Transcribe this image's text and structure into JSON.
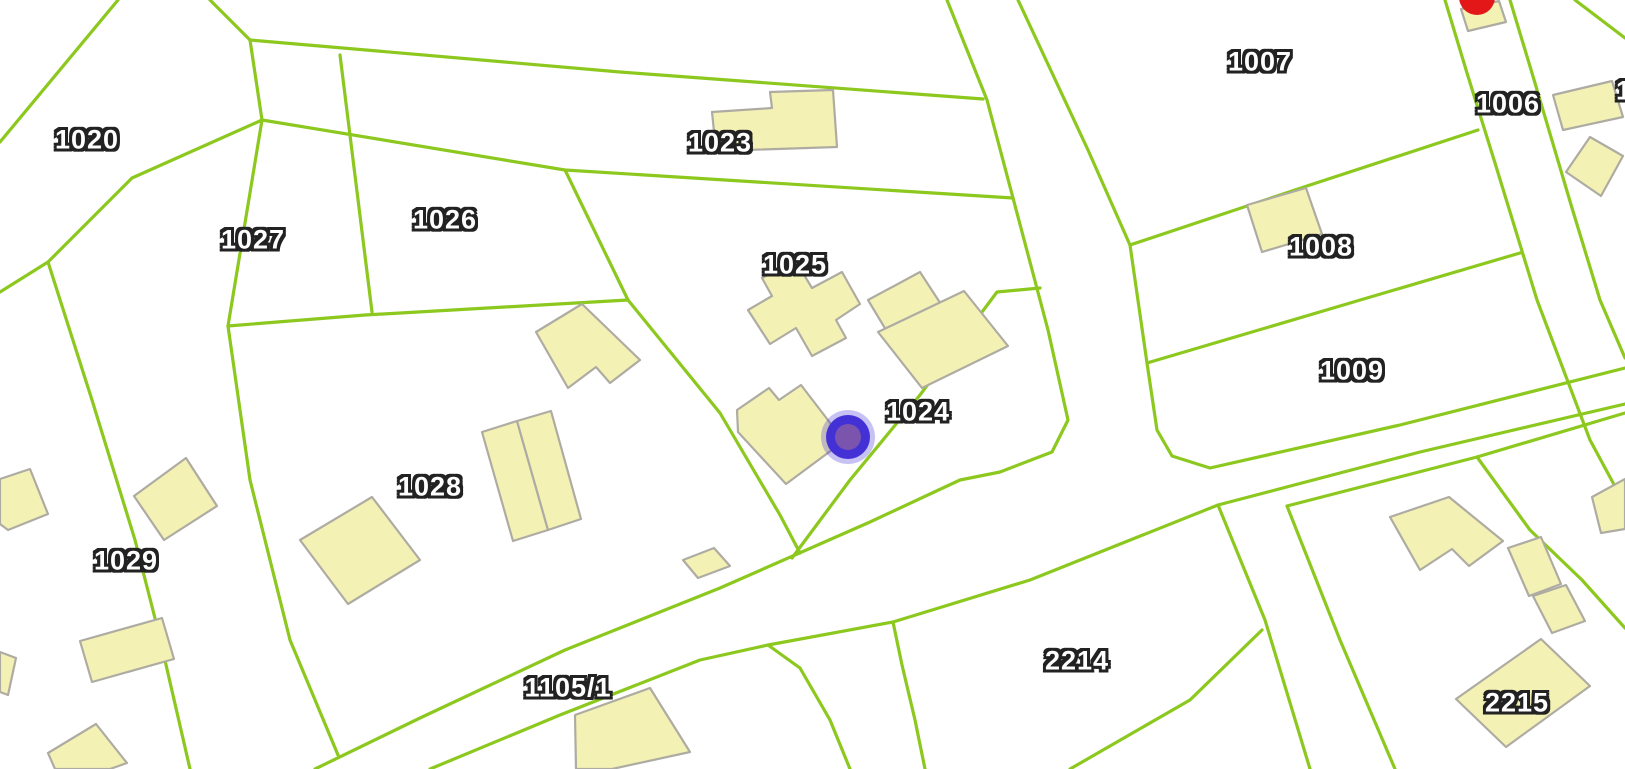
{
  "map": {
    "type": "cadastral-parcel-map",
    "colors": {
      "background": "#ffffff",
      "parcel_line": "#8cc81e",
      "building_fill": "#f4f1b4",
      "building_stroke": "#aeaca2",
      "label_fill": "#ffffff",
      "label_outline": "#222222",
      "location_marker_blue": "#4331d5",
      "location_marker_purple": "#7b55ad",
      "poi_marker_red": "#e31717"
    },
    "parcel_labels": [
      {
        "text": "1020",
        "x": 87,
        "y": 140
      },
      {
        "text": "1027",
        "x": 253,
        "y": 240
      },
      {
        "text": "1026",
        "x": 445,
        "y": 220
      },
      {
        "text": "1023",
        "x": 720,
        "y": 143
      },
      {
        "text": "1025",
        "x": 795,
        "y": 265
      },
      {
        "text": "1024",
        "x": 918,
        "y": 412
      },
      {
        "text": "1028",
        "x": 430,
        "y": 487
      },
      {
        "text": "1029",
        "x": 126,
        "y": 561
      },
      {
        "text": "1105/1",
        "x": 568,
        "y": 688
      },
      {
        "text": "2214",
        "x": 1077,
        "y": 661
      },
      {
        "text": "2215",
        "x": 1517,
        "y": 703
      },
      {
        "text": "1007",
        "x": 1260,
        "y": 62
      },
      {
        "text": "1006",
        "x": 1508,
        "y": 104
      },
      {
        "text": "1008",
        "x": 1321,
        "y": 247
      },
      {
        "text": "1009",
        "x": 1352,
        "y": 371
      },
      {
        "text": "1",
        "x": 1624,
        "y": 91
      }
    ],
    "markers": [
      {
        "name": "location-marker",
        "x": 848,
        "y": 437,
        "rings": [
          {
            "r": 27,
            "fill": "#4634d8",
            "opacity": 0.3
          },
          {
            "r": 22,
            "fill": "#4331d5",
            "opacity": 1
          },
          {
            "r": 13,
            "fill": "#7b55ad",
            "opacity": 1
          }
        ]
      },
      {
        "name": "poi-marker-red",
        "x": 1477,
        "y": -3,
        "rings": [
          {
            "r": 18,
            "fill": "#e31717",
            "opacity": 1
          }
        ]
      }
    ]
  }
}
